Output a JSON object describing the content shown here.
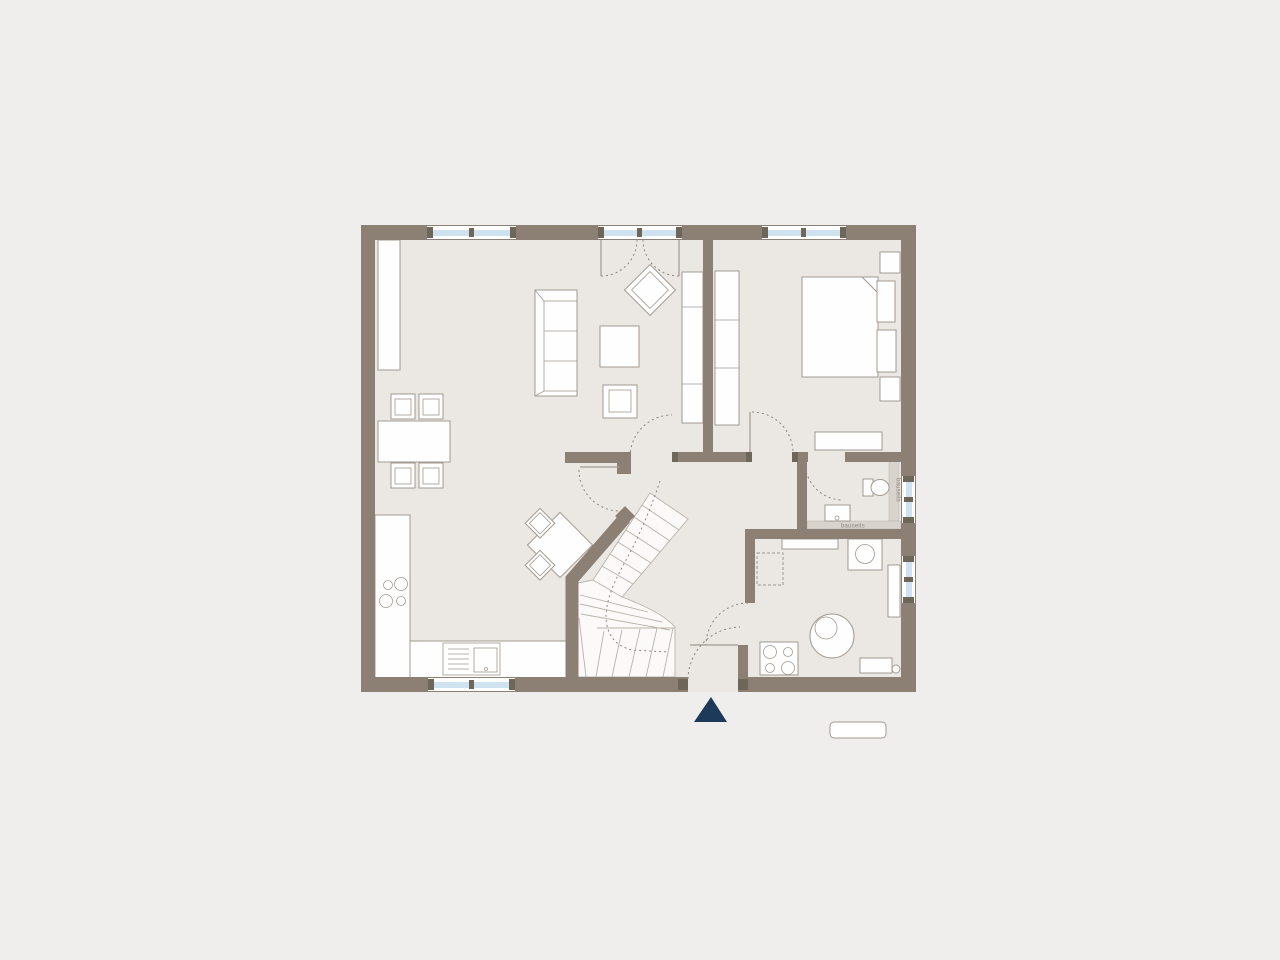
{
  "labels": {
    "shaft_vertical": "bauseits",
    "shaft_horizontal": "bauseits"
  },
  "colors": {
    "bg": "#f0eeec",
    "floor": "#ebe7e3",
    "wall": "#8c8074",
    "furniture-stroke": "#a29a91",
    "tread": "#b9b2aa",
    "dash": "#8d857c",
    "window-glass": "#cfe2f0",
    "window-cap": "#6e6759",
    "shaft-band": "#d8d3cd",
    "label-text": "#8d857c",
    "entrance-marker": "#1e3a5a"
  },
  "symbols": [
    "wardrobe",
    "sofa",
    "coffee-table",
    "armchair",
    "dining-table",
    "dining-chair",
    "tall-cabinet",
    "double-bed",
    "nightstand",
    "headboard",
    "dresser",
    "kitchen-counter",
    "hob",
    "kitchen-sink",
    "kitchen-table",
    "kitchen-chair",
    "winder-staircase",
    "wash-basin",
    "toilet",
    "shelf",
    "washing-machine",
    "boiler",
    "radiator",
    "utility-hob",
    "utility-cabinet",
    "entrance-triangle-marker"
  ]
}
